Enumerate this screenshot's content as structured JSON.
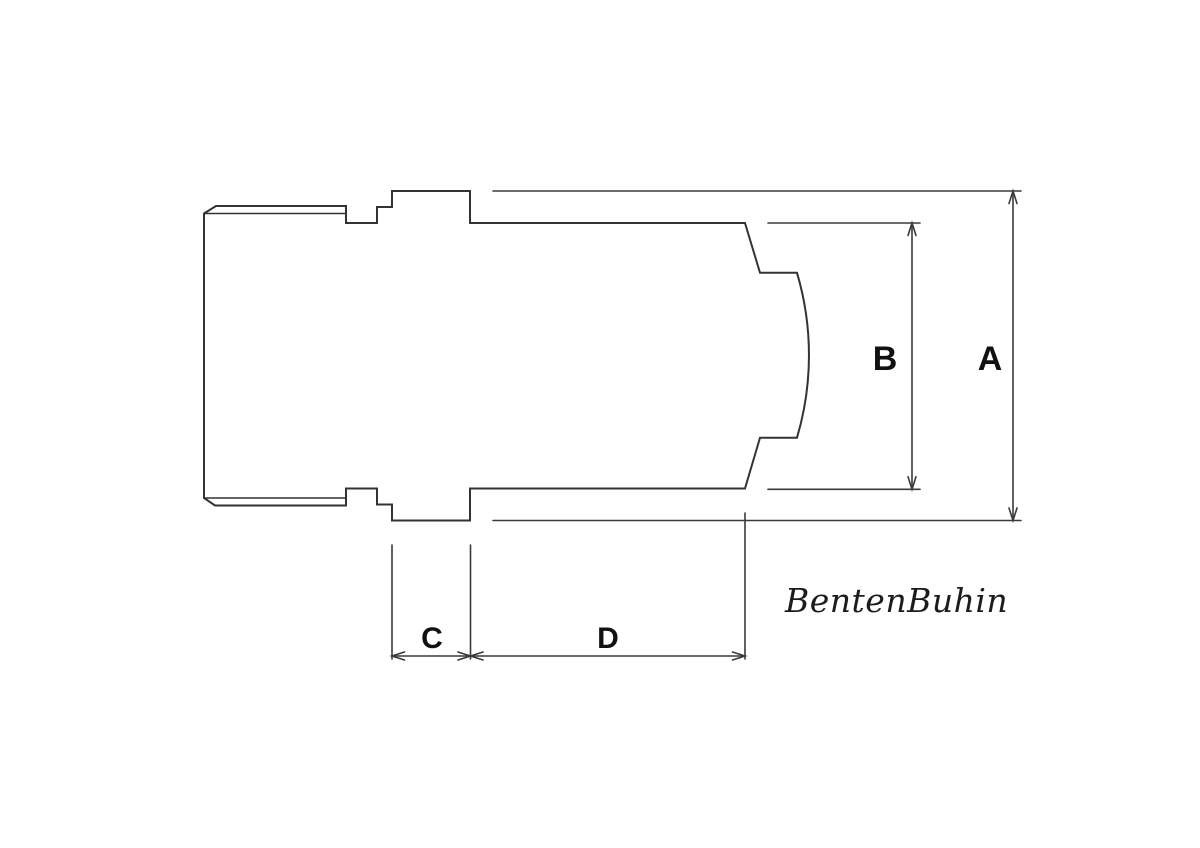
{
  "labels": {
    "A": "A",
    "B": "B",
    "C": "C",
    "D": "D"
  },
  "signature": "BentenBuhin",
  "colors": {
    "outline": "#333333",
    "dimension_lines": "#3a3a3a",
    "label_text": "#111111",
    "signature_text": "#1c1c1c",
    "background": "#ffffff"
  }
}
